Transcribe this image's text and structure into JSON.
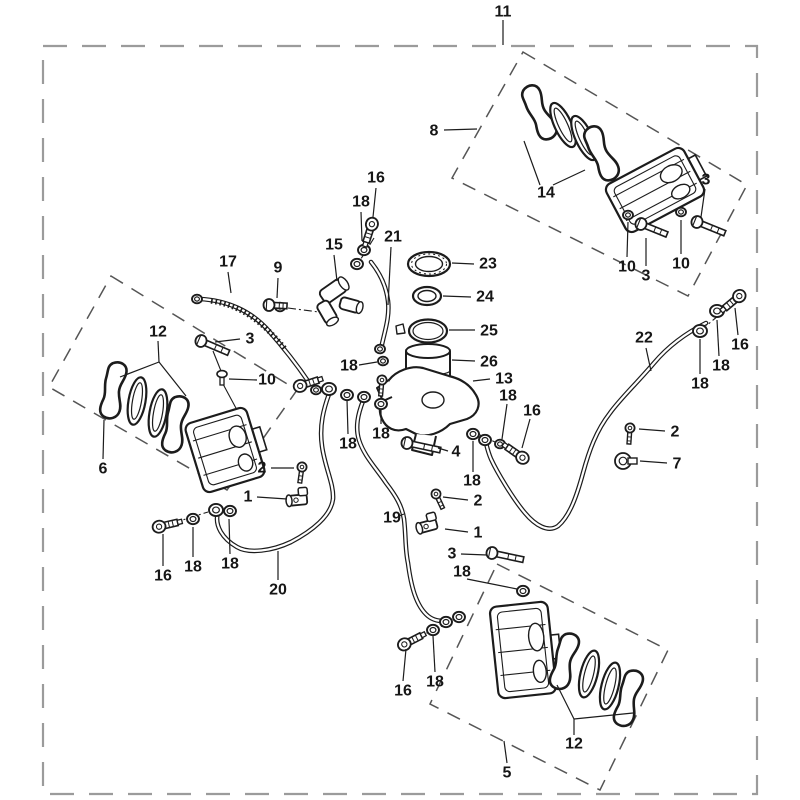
{
  "meta": {
    "type": "exploded-parts-diagram",
    "subject": "brake system (calipers, master cylinder, hoses)"
  },
  "canvas": {
    "width": 800,
    "height": 800,
    "background": "#ffffff",
    "ink": "#1c1c1c",
    "border_color": "#9b9b9b"
  },
  "border": {
    "x": 43,
    "y": 46,
    "width": 714,
    "height": 748,
    "dash": "24 15"
  },
  "group_boxes": [
    {
      "name": "rear-caliper-group",
      "points": "523,52 747,185 688,296 452,178"
    },
    {
      "name": "left-caliper-group",
      "points": "111,276 297,390 227,490 49,387"
    },
    {
      "name": "bottom-caliper-group",
      "points": "497,564 668,650 600,790 430,704"
    }
  ],
  "callouts": [
    {
      "part": "11",
      "x": 503,
      "y": 12,
      "leaders": [
        [
          503,
          20,
          503,
          45
        ]
      ]
    },
    {
      "part": "8",
      "x": 434,
      "y": 131,
      "leaders": [
        [
          444,
          130,
          477,
          129
        ]
      ]
    },
    {
      "part": "14",
      "x": 546,
      "y": 193,
      "leaders": [
        [
          540,
          185,
          524,
          141
        ],
        [
          553,
          185,
          585,
          170
        ]
      ]
    },
    {
      "part": "3",
      "x": 706,
      "y": 180,
      "leaders": [
        [
          705,
          189,
          701,
          217
        ]
      ]
    },
    {
      "part": "10",
      "x": 627,
      "y": 267,
      "leaders": [
        [
          627,
          257,
          628,
          222
        ]
      ]
    },
    {
      "part": "3",
      "x": 646,
      "y": 276,
      "leaders": [
        [
          646,
          266,
          646,
          238
        ]
      ]
    },
    {
      "part": "10",
      "x": 681,
      "y": 264,
      "leaders": [
        [
          681,
          254,
          681,
          220
        ]
      ]
    },
    {
      "part": "16",
      "x": 740,
      "y": 345,
      "leaders": [
        [
          738,
          335,
          735,
          308
        ]
      ]
    },
    {
      "part": "18",
      "x": 721,
      "y": 366,
      "leaders": [
        [
          719,
          356,
          717,
          320
        ]
      ]
    },
    {
      "part": "18",
      "x": 700,
      "y": 384,
      "leaders": [
        [
          700,
          374,
          700,
          339
        ]
      ]
    },
    {
      "part": "22",
      "x": 644,
      "y": 338,
      "leaders": [
        [
          646,
          348,
          651,
          371
        ]
      ]
    },
    {
      "part": "2",
      "x": 675,
      "y": 432,
      "leaders": [
        [
          665,
          431,
          639,
          429
        ]
      ]
    },
    {
      "part": "7",
      "x": 677,
      "y": 464,
      "leaders": [
        [
          667,
          463,
          640,
          461
        ]
      ]
    },
    {
      "part": "16",
      "x": 376,
      "y": 178,
      "leaders": [
        [
          376,
          188,
          373,
          217
        ]
      ]
    },
    {
      "part": "18",
      "x": 361,
      "y": 202,
      "leaders": [
        [
          361,
          212,
          362,
          241
        ]
      ]
    },
    {
      "part": "21",
      "x": 393,
      "y": 237,
      "leaders": [
        [
          391,
          247,
          388,
          305
        ]
      ]
    },
    {
      "part": "15",
      "x": 334,
      "y": 245,
      "leaders": [
        [
          334,
          255,
          337,
          281
        ]
      ]
    },
    {
      "part": "17",
      "x": 228,
      "y": 262,
      "leaders": [
        [
          228,
          272,
          231,
          293
        ]
      ]
    },
    {
      "part": "9",
      "x": 278,
      "y": 268,
      "leaders": [
        [
          278,
          278,
          277,
          298
        ]
      ]
    },
    {
      "part": "23",
      "x": 488,
      "y": 264,
      "leaders": [
        [
          474,
          264,
          452,
          263
        ]
      ]
    },
    {
      "part": "24",
      "x": 485,
      "y": 297,
      "leaders": [
        [
          471,
          297,
          443,
          296
        ]
      ]
    },
    {
      "part": "25",
      "x": 489,
      "y": 331,
      "leaders": [
        [
          475,
          330,
          449,
          330
        ]
      ]
    },
    {
      "part": "26",
      "x": 489,
      "y": 362,
      "leaders": [
        [
          475,
          361,
          452,
          360
        ]
      ]
    },
    {
      "part": "13",
      "x": 504,
      "y": 379,
      "leaders": [
        [
          490,
          379,
          473,
          381
        ]
      ]
    },
    {
      "part": "18",
      "x": 508,
      "y": 396,
      "leaders": [
        [
          507,
          404,
          502,
          439
        ]
      ]
    },
    {
      "part": "16",
      "x": 532,
      "y": 411,
      "leaders": [
        [
          530,
          419,
          522,
          448
        ]
      ]
    },
    {
      "part": "18",
      "x": 472,
      "y": 481,
      "leaders": [
        [
          473,
          472,
          473,
          441
        ]
      ]
    },
    {
      "part": "12",
      "x": 158,
      "y": 332,
      "leaders": [
        [
          158,
          341,
          159,
          362
        ],
        [
          159,
          362,
          120,
          377
        ],
        [
          159,
          362,
          186,
          396
        ]
      ]
    },
    {
      "part": "3",
      "x": 250,
      "y": 339,
      "leaders": [
        [
          240,
          339,
          215,
          342
        ]
      ]
    },
    {
      "part": "10",
      "x": 267,
      "y": 380,
      "leaders": [
        [
          257,
          380,
          229,
          379
        ]
      ]
    },
    {
      "part": "6",
      "x": 103,
      "y": 469,
      "leaders": [
        [
          103,
          459,
          104,
          420
        ]
      ]
    },
    {
      "part": "2",
      "x": 262,
      "y": 468,
      "leaders": [
        [
          271,
          468,
          294,
          468
        ]
      ]
    },
    {
      "part": "1",
      "x": 248,
      "y": 497,
      "leaders": [
        [
          257,
          497,
          287,
          499
        ]
      ]
    },
    {
      "part": "16",
      "x": 163,
      "y": 576,
      "leaders": [
        [
          163,
          566,
          163,
          534
        ]
      ]
    },
    {
      "part": "18",
      "x": 193,
      "y": 567,
      "leaders": [
        [
          193,
          557,
          193,
          527
        ]
      ]
    },
    {
      "part": "18",
      "x": 230,
      "y": 564,
      "leaders": [
        [
          230,
          554,
          229,
          519
        ]
      ]
    },
    {
      "part": "20",
      "x": 278,
      "y": 590,
      "leaders": [
        [
          278,
          580,
          278,
          551
        ]
      ]
    },
    {
      "part": "19",
      "x": 392,
      "y": 518,
      "leaders": [
        [
          399,
          516,
          404,
          514
        ]
      ]
    },
    {
      "part": "2",
      "x": 478,
      "y": 501,
      "leaders": [
        [
          468,
          500,
          443,
          497
        ]
      ]
    },
    {
      "part": "1",
      "x": 478,
      "y": 533,
      "leaders": [
        [
          468,
          532,
          445,
          529
        ]
      ]
    },
    {
      "part": "3",
      "x": 452,
      "y": 554,
      "leaders": [
        [
          461,
          554,
          487,
          555
        ]
      ]
    },
    {
      "part": "18",
      "x": 462,
      "y": 572,
      "leaders": [
        [
          467,
          579,
          517,
          589
        ]
      ]
    },
    {
      "part": "4",
      "x": 456,
      "y": 452,
      "leaders": [
        [
          448,
          451,
          438,
          448
        ]
      ]
    },
    {
      "part": "18",
      "x": 349,
      "y": 366,
      "leaders": [
        [
          359,
          365,
          377,
          362
        ]
      ]
    },
    {
      "part": "18",
      "x": 381,
      "y": 434,
      "leaders": [
        [
          381,
          424,
          381,
          409
        ]
      ]
    },
    {
      "part": "18",
      "x": 348,
      "y": 444,
      "leaders": [
        [
          348,
          434,
          347,
          400
        ]
      ]
    },
    {
      "part": "16",
      "x": 403,
      "y": 691,
      "leaders": [
        [
          403,
          681,
          406,
          649
        ]
      ]
    },
    {
      "part": "18",
      "x": 435,
      "y": 682,
      "leaders": [
        [
          435,
          672,
          433,
          636
        ]
      ]
    },
    {
      "part": "12",
      "x": 574,
      "y": 744,
      "leaders": [
        [
          574,
          735,
          574,
          719
        ],
        [
          574,
          719,
          557,
          685
        ],
        [
          574,
          719,
          633,
          713
        ]
      ]
    },
    {
      "part": "5",
      "x": 507,
      "y": 773,
      "leaders": [
        [
          507,
          763,
          504,
          741
        ]
      ]
    }
  ],
  "hoses": [
    {
      "name": "brake-pipe-17",
      "d": "M199,299 C228,300 252,312 268,330 C283,347 298,366 310,384",
      "wrap": "M211,301 C241,305 263,322 286,350"
    },
    {
      "name": "brake-hose-20",
      "d": "M329,394 C324,408 319,425 322,446 C325,468 334,484 333,499 C331,516 312,531 291,542 C272,551 249,554 237,547 C223,539 214,526 218,512"
    },
    {
      "name": "brake-hose-19",
      "d": "M363,401 C358,414 355,427 359,440 C364,456 376,468 386,483 C396,496 402,506 404,519 C406,536 405,549 408,563 C411,586 416,606 428,616 C433,620 440,622 445,620"
    },
    {
      "name": "brake-hose-21",
      "d": "M371,262 C379,272 386,284 388,301 C390,318 384,333 381,349"
    },
    {
      "name": "brake-hose-22",
      "d": "M706,323 C688,332 670,344 654,363 C637,383 620,399 610,413 C596,431 589,451 583,473 C577,495 570,516 558,526 C548,533 535,525 525,513 C513,499 497,472 491,459 C488,452 487,447 486,443"
    }
  ],
  "chain_lines": [
    [
      288,
      308,
      334,
      314
    ],
    [
      173,
      523,
      208,
      512
    ],
    [
      374,
      238,
      359,
      262
    ],
    [
      731,
      305,
      706,
      326
    ],
    [
      514,
      451,
      478,
      434
    ],
    [
      412,
      640,
      442,
      626
    ],
    [
      309,
      384,
      325,
      389
    ]
  ],
  "guide_lines": [
    [
      213,
      351,
      221,
      371
    ],
    [
      223,
      384,
      237,
      410
    ]
  ],
  "rings": [
    [
      197,
      299,
      5
    ],
    [
      717,
      311,
      7
    ],
    [
      700,
      331,
      7
    ],
    [
      364,
      250,
      6
    ],
    [
      357,
      264,
      6
    ],
    [
      316,
      390,
      5
    ],
    [
      329,
      389,
      7
    ],
    [
      347,
      395,
      6
    ],
    [
      364,
      397,
      6
    ],
    [
      381,
      404,
      6
    ],
    [
      380,
      349,
      5
    ],
    [
      383,
      361,
      5
    ],
    [
      473,
      434,
      6
    ],
    [
      485,
      440,
      6
    ],
    [
      500,
      444,
      5
    ],
    [
      193,
      519,
      6
    ],
    [
      216,
      510,
      7
    ],
    [
      230,
      511,
      6
    ],
    [
      433,
      630,
      6
    ],
    [
      446,
      622,
      6
    ],
    [
      459,
      617,
      6
    ],
    [
      523,
      591,
      6
    ],
    [
      628,
      215,
      5
    ],
    [
      681,
      212,
      5
    ],
    [
      280,
      307,
      5
    ]
  ],
  "banjo_bolts": [
    [
      737,
      298,
      140
    ],
    [
      371,
      227,
      108
    ],
    [
      162,
      526,
      -13
    ],
    [
      303,
      385,
      -18
    ],
    [
      520,
      456,
      -145
    ],
    [
      407,
      643,
      -27
    ]
  ],
  "hex_bolts": [
    [
      201,
      341,
      23,
      26
    ],
    [
      641,
      224,
      22,
      24
    ],
    [
      697,
      222,
      22,
      26
    ],
    [
      492,
      553,
      12,
      28
    ],
    [
      407,
      443,
      12,
      30
    ],
    [
      269,
      305,
      3,
      14
    ]
  ],
  "screw_bolts": [
    [
      302,
      467,
      8
    ],
    [
      630,
      428,
      4
    ],
    [
      436,
      494,
      -25
    ],
    [
      382,
      380,
      5
    ]
  ],
  "elbow_fittings": [
    [
      298,
      500,
      -5
    ],
    [
      428,
      526,
      -15
    ]
  ],
  "clamp_fittings": [
    [
      623,
      461
    ]
  ],
  "pins": [
    [
      222,
      376
    ]
  ],
  "pads": [
    [
      541,
      112,
      -25,
      "pad"
    ],
    [
      563,
      125,
      -25,
      "shim"
    ],
    [
      584,
      138,
      -25,
      "shim"
    ],
    [
      603,
      153,
      -25,
      "pad"
    ],
    [
      115,
      391,
      10,
      "pad"
    ],
    [
      137,
      401,
      10,
      "shim"
    ],
    [
      158,
      413,
      10,
      "shim"
    ],
    [
      177,
      425,
      10,
      "pad"
    ],
    [
      566,
      662,
      14,
      "pad"
    ],
    [
      589,
      674,
      14,
      "shim"
    ],
    [
      610,
      686,
      14,
      "shim"
    ],
    [
      630,
      699,
      14,
      "pad"
    ]
  ],
  "calipers": [
    [
      655,
      190,
      -28,
      88,
      54
    ],
    [
      225,
      450,
      -17,
      64,
      72
    ],
    [
      523,
      650,
      -6,
      58,
      92
    ]
  ],
  "cylinders": [
    [
      333,
      291,
      -35,
      26,
      15
    ],
    [
      327,
      312,
      60,
      22,
      13
    ],
    [
      350,
      305,
      15,
      20,
      12
    ]
  ],
  "shapes": [
    {
      "name": "reservoir-cup",
      "type": "path",
      "d": "M406,351 L406,390 C406,397.5 415.5,402 428,402 C440.5,402 450,397.5 450,390 L450,351",
      "sw": 2,
      "fill": "#fff"
    },
    {
      "name": "reservoir-cup-top",
      "type": "path",
      "d": "M406,351 C406,347.2 415.8,344 428,344 C440.2,344 450,347.2 450,351 C450,354.8 440.2,358 428,358 C415.8,358 406,354.8 406,351 Z",
      "sw": 2,
      "fill": "#fff"
    },
    {
      "name": "reservoir-cup-band",
      "type": "path",
      "d": "M406,371 C410,376.5 446,376.5 450,371",
      "sw": 1.1,
      "fill": "none"
    },
    {
      "name": "master-cylinder-body",
      "type": "path",
      "d": "M389,380 C396,371 411,365 423,368 L449,376 C462,379 471,386 476,395 C482,405 477,415 467,419 L450,424 C441,433 427,438 416,434 L406,429 C395,433 386,428 382,419 C377,409 381,397 389,380 Z",
      "sw": 2.2,
      "fill": "#fff"
    },
    {
      "name": "master-cylinder-bore",
      "type": "ellipse",
      "cx": 433,
      "cy": 400,
      "rx": 11,
      "ry": 8,
      "sw": 1.4,
      "fill": "none"
    },
    {
      "name": "master-cylinder-port",
      "type": "path",
      "d": "M416,434 L412,450 L432,455 L436,436",
      "sw": 2,
      "fill": "#fff"
    },
    {
      "name": "master-cylinder-boss",
      "type": "path",
      "d": "M389,380 L377,388 L383,401 L392,397",
      "sw": 2,
      "fill": "#fff"
    },
    {
      "name": "reservoir-cap",
      "type": "ellipse",
      "cx": 429,
      "cy": 264,
      "rx": 21,
      "ry": 12,
      "sw": 2.2,
      "fill": "#fff"
    },
    {
      "name": "reservoir-cap-knurl",
      "type": "ellipse",
      "cx": 429,
      "cy": 264,
      "rx": 17.5,
      "ry": 10,
      "sw": 1,
      "fill": "none",
      "dash": "2 3"
    },
    {
      "name": "reservoir-cap-inner",
      "type": "ellipse",
      "cx": 429,
      "cy": 264,
      "rx": 13.5,
      "ry": 7.5,
      "sw": 1.4,
      "fill": "none"
    },
    {
      "name": "diaphragm-ring",
      "type": "ellipse",
      "cx": 427,
      "cy": 296,
      "rx": 14,
      "ry": 9,
      "sw": 2.2,
      "fill": "#fff"
    },
    {
      "name": "diaphragm-ring-inner",
      "type": "ellipse",
      "cx": 427,
      "cy": 296,
      "rx": 9,
      "ry": 5.5,
      "sw": 1.4,
      "fill": "none"
    },
    {
      "name": "hose-clamp-band",
      "type": "ellipse",
      "cx": 428,
      "cy": 331,
      "rx": 19,
      "ry": 11.5,
      "sw": 2.2,
      "fill": "#fff"
    },
    {
      "name": "hose-clamp-band-inner",
      "type": "ellipse",
      "cx": 428,
      "cy": 331,
      "rx": 15,
      "ry": 8.5,
      "sw": 1.2,
      "fill": "none"
    },
    {
      "name": "hose-clamp-screw",
      "type": "path",
      "d": "M403,324 l-7,2 1,8 8,-1 z",
      "sw": 1.4,
      "fill": "#fff"
    }
  ]
}
